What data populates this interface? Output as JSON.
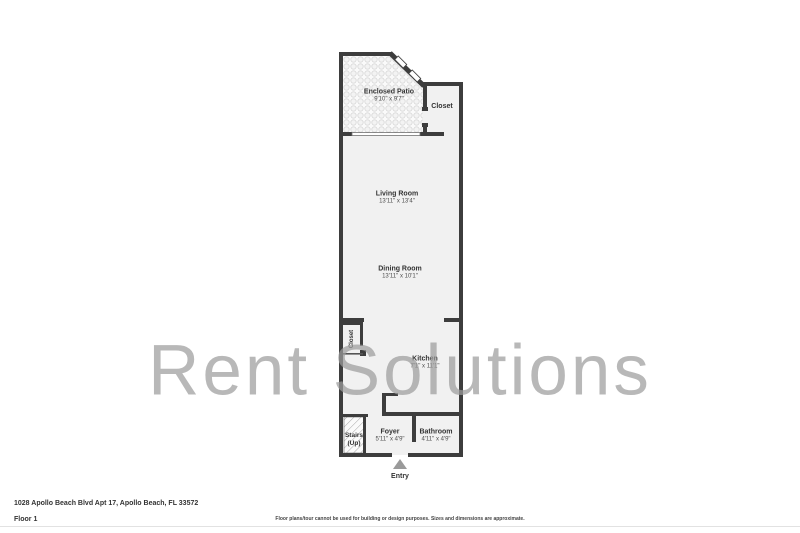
{
  "page": {
    "watermark": "Rent Solutions",
    "address": "1028 Apollo Beach Blvd Apt 17, Apollo Beach, FL 33572",
    "floor_label": "Floor 1",
    "disclaimer": "Floor plans/tour cannot be used for building or design purposes. Sizes and dimensions are approximate."
  },
  "plan": {
    "rooms": {
      "patio": {
        "name": "Enclosed Patio",
        "dims": "9'10\" x 9'7\""
      },
      "closet_upper": {
        "name": "Closet"
      },
      "living": {
        "name": "Living Room",
        "dims": "13'11\" x 13'4\""
      },
      "dining": {
        "name": "Dining Room",
        "dims": "13'11\" x 10'1\""
      },
      "closet_hall": {
        "name": "Closet"
      },
      "kitchen": {
        "name": "Kitchen",
        "dims": "7'1\" x 11'1\""
      },
      "stairs": {
        "line1": "Stairs",
        "line2": "(Up)"
      },
      "foyer": {
        "name": "Foyer",
        "dims": "5'11\" x 4'9\""
      },
      "bathroom": {
        "name": "Bathroom",
        "dims": "4'11\" x 4'9\""
      },
      "entry": {
        "name": "Entry"
      }
    },
    "colors": {
      "wall": "#3d3d3d",
      "floor": "#f1f1f1",
      "patio_tile_line": "#d9d9d9",
      "entry_arrow": "#9a9a9a",
      "watermark": "#9d9d9d"
    }
  }
}
